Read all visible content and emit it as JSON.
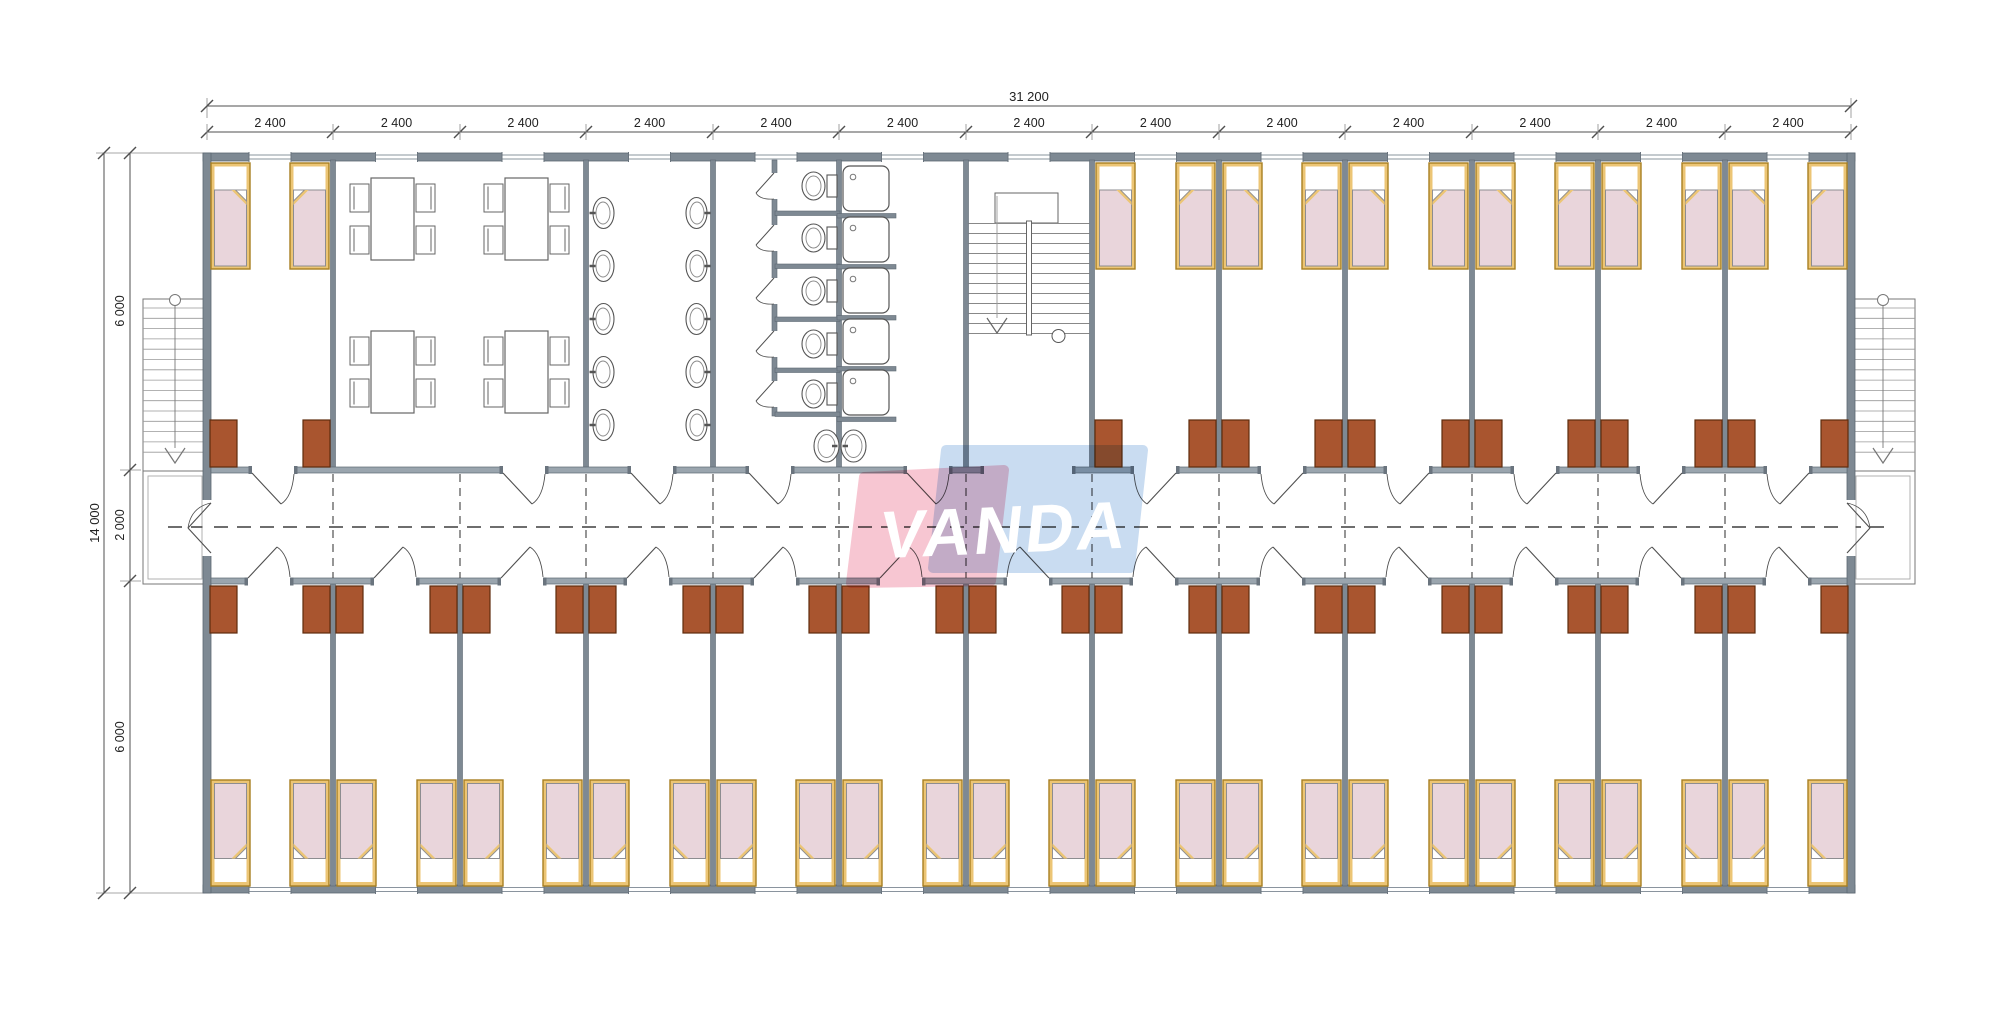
{
  "page": {
    "background": "#ffffff"
  },
  "logo": {
    "text": "VANDA",
    "pink": "#f5bac8",
    "blue": "#bdd5ee",
    "text_color": "#ffffff"
  },
  "dimensions": {
    "total_width_label": "31 200",
    "bay_width_label": "2 400",
    "bay_count": 13,
    "total_height_label": "14 000",
    "height_segment_labels": [
      "6 000",
      "2 000",
      "6 000"
    ]
  },
  "colors": {
    "wall": "#7e8993",
    "wall_stroke": "#5d6872",
    "corridor_wall": "#9aa5ae",
    "cap": "#6a747e",
    "line": "#4f4f4f",
    "thin": "#8a8a8a",
    "bed_frame": "#ecc575",
    "bed_frame_stroke": "#a87f22",
    "blanket": "#e9d5db",
    "blanket_stroke": "#8d8d90",
    "cabinet": "#a9552f",
    "cabinet_stroke": "#5f2c0d",
    "dash": "#3f3f3f",
    "dim_text": "#222222"
  },
  "floor_plan": {
    "zones_top": [
      "bedroom",
      "dining",
      "washbasins",
      "toilets",
      "showers",
      "staircase",
      "bedroom",
      "bedroom",
      "bedroom",
      "bedroom",
      "bedroom",
      "bedroom"
    ],
    "zones_bottom": [
      "bedroom",
      "bedroom",
      "bedroom",
      "bedroom",
      "bedroom",
      "bedroom",
      "bedroom",
      "bedroom",
      "bedroom",
      "bedroom",
      "bedroom",
      "bedroom",
      "bedroom"
    ],
    "counts": {
      "beds_top": 14,
      "beds_bottom": 26,
      "dining_tables": 4,
      "washbasins": 12,
      "toilets": 5,
      "showers": 5,
      "external_stairs": 2,
      "internal_stairs": 1
    }
  }
}
